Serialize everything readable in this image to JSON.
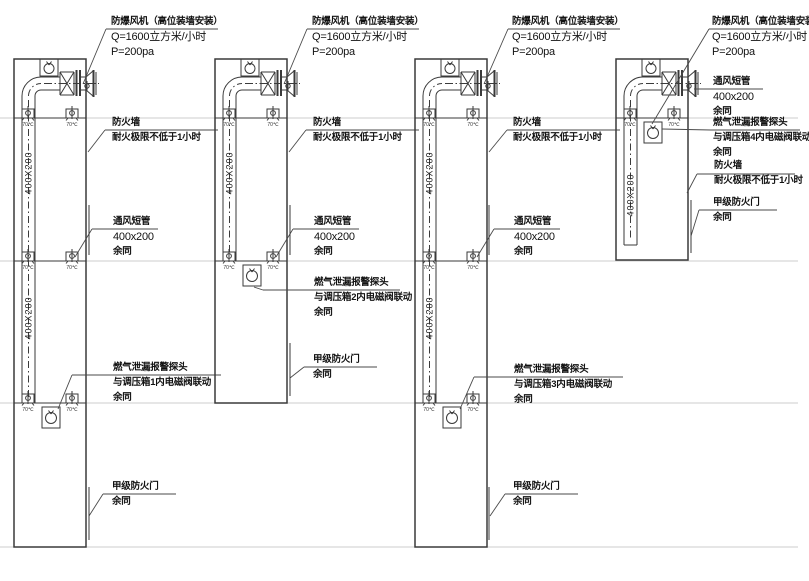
{
  "drawing": {
    "background": "#ffffff",
    "line_color": "#3a3a3a",
    "floor_line_color": "#cccccc",
    "duct_size_label": "400X200",
    "damper_label": "70℃"
  },
  "assemblies": [
    {
      "fan": {
        "line1": "防爆风机（高位装墙安装）",
        "line2": "Q=1600立方米/小时",
        "line3": "P=200pa"
      },
      "firewall": {
        "line1": "防火墙",
        "line2": "耐火极限不低于1小时"
      },
      "short_pipe": {
        "line1": "通风短管",
        "line2": "400x200",
        "line3": "余同"
      },
      "gas": {
        "line1": "燃气泄漏报警探头",
        "line2": "与调压箱1内电磁阀联动",
        "line3": "余同"
      },
      "door": {
        "line1": "甲级防火门",
        "line2": "余同"
      }
    },
    {
      "fan": {
        "line1": "防爆风机（高位装墙安装）",
        "line2": "Q=1600立方米/小时",
        "line3": "P=200pa"
      },
      "firewall": {
        "line1": "防火墙",
        "line2": "耐火极限不低于1小时"
      },
      "short_pipe": {
        "line1": "通风短管",
        "line2": "400x200",
        "line3": "余同"
      },
      "gas": {
        "line1": "燃气泄漏报警探头",
        "line2": "与调压箱2内电磁阀联动",
        "line3": "余同"
      },
      "door": {
        "line1": "甲级防火门",
        "line2": "余同"
      }
    },
    {
      "fan": {
        "line1": "防爆风机（高位装墙安装）",
        "line2": "Q=1600立方米/小时",
        "line3": "P=200pa"
      },
      "firewall": {
        "line1": "防火墙",
        "line2": "耐火极限不低于1小时"
      },
      "short_pipe": {
        "line1": "通风短管",
        "line2": "400x200",
        "line3": "余同"
      },
      "gas": {
        "line1": "燃气泄漏报警探头",
        "line2": "与调压箱3内电磁阀联动",
        "line3": "余同"
      },
      "door": {
        "line1": "甲级防火门",
        "line2": "余同"
      }
    },
    {
      "fan": {
        "line1": "防爆风机（高位装墙安装）",
        "line2": "Q=1600立方米/小时",
        "line3": "P=200pa"
      },
      "firewall": {
        "line1": "防火墙",
        "line2": "耐火极限不低于1小时"
      },
      "short_pipe": {
        "line1": "通风短管",
        "line2": "400x200",
        "line3": "余同"
      },
      "gas": {
        "line1": "燃气泄漏报警探头",
        "line2": "与调压箱4内电磁阀联动",
        "line3": "余同"
      },
      "door": {
        "line1": "甲级防火门",
        "line2": "余同"
      }
    }
  ]
}
